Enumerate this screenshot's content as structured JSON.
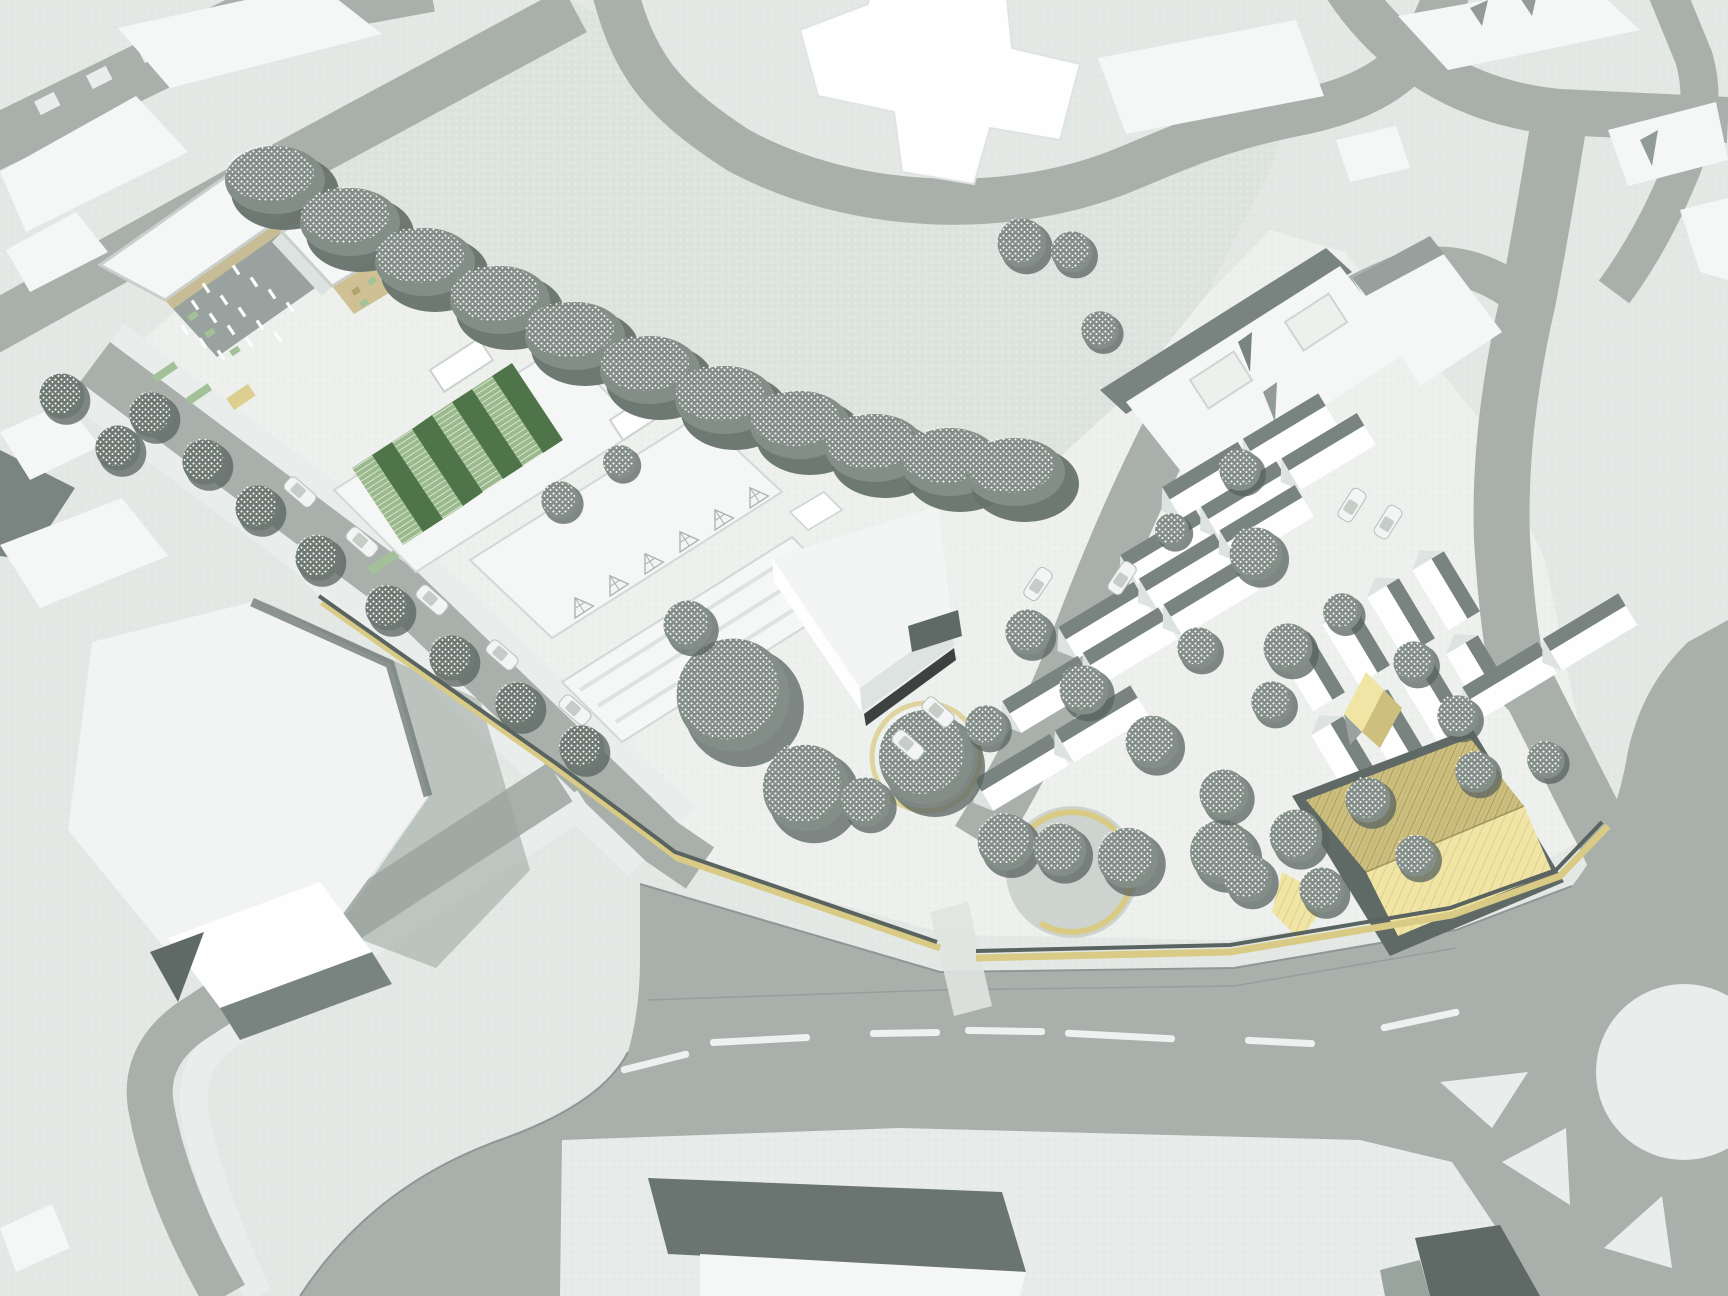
{
  "scene": {
    "title": "Urban masterplan aerial rendering",
    "description": "Bird's-eye axonometric architectural render of a mixed-use regeneration site: apartment blocks with timber and green facades, sheds with green sawtooth glazing, white office massing, rows of gabled terraced housing, a small timber pavilion and a large timber hall, a gold site boundary wall, a tree-lined avenue with parked cars, an open green field, and a main road with centre-line markings and a roundabout",
    "view": "aerial-axonometric",
    "labels": {
      "residential_west": "apartment blocks with timber and green facades",
      "greenhouse_sheds": "sheds with green sawtooth glazing",
      "office_slabs": "white office slabs",
      "office_box": "white office box with dark plinth",
      "terraced_housing": "gabled terraced housing rows",
      "courtyard_building": "L-shaped courtyard building",
      "timber_chapel": "small timber gabled pavilion",
      "timber_hall": "large timber gabled hall",
      "boundary_wall": "gold site boundary wall",
      "avenue": "tree-lined avenue with parked cars",
      "main_road": "main road with centre-line markings",
      "roundabout": "roundabout with traffic islands",
      "field": "open green space",
      "tree_line": "mature tree belt",
      "plaza": "circular plaza with seating wall"
    }
  },
  "colors": {
    "bg": "#e3e8e5",
    "field": "#dde3df",
    "site": "#edf0ed",
    "south": "#e7ebe9",
    "road": "#a9b0ac",
    "road_edge": "#8f9794",
    "white_roof": "#f4f7f5",
    "white_bright": "#fefefe",
    "facade_light": "#dde3e0",
    "facade_gray": "#99a29e",
    "facade_dark": "#79837f",
    "shadow_dark": "#5f6a67",
    "shadow_mid": "#9aa49f",
    "tan": "#cfc193",
    "tan_dark": "#b2a26e",
    "green_glass": "#9ab98c",
    "green_dark": "#50744a",
    "green_screen": "#a3c199",
    "timber_light": "#f0e5a4",
    "timber_mid": "#cdbf7e",
    "timber_dark": "#a2955c",
    "wall_gold": "#d9cb85",
    "wall_top": "#59635f",
    "tree": "#848e89",
    "tree_street": "#6e7973",
    "tree_shadow": "#58635f",
    "tree_line": "#67726c",
    "car": "#f2f5f3",
    "marking": "#eef1ef",
    "island": "#e9edeb",
    "black": "#1d2321"
  },
  "treeline": [
    [
      275,
      180
    ],
    [
      350,
      222
    ],
    [
      425,
      262
    ],
    [
      500,
      300
    ],
    [
      575,
      336
    ],
    [
      650,
      370
    ],
    [
      725,
      400
    ],
    [
      800,
      425
    ],
    [
      875,
      448
    ],
    [
      950,
      462
    ],
    [
      1015,
      472
    ]
  ],
  "trees": {
    "street": [
      [
        152,
        415
      ],
      [
        205,
        462
      ],
      [
        258,
        508
      ],
      [
        318,
        558
      ],
      [
        388,
        608
      ],
      [
        452,
        658
      ],
      [
        518,
        705
      ],
      [
        582,
        748
      ],
      [
        118,
        448
      ],
      [
        62,
        396
      ]
    ],
    "park": [
      [
        733,
        695,
        60
      ],
      [
        806,
        788,
        46
      ],
      [
        926,
        757,
        50
      ],
      [
        688,
        625,
        26
      ],
      [
        1006,
        842,
        30
      ],
      [
        1128,
        858,
        32
      ],
      [
        1222,
        852,
        34
      ],
      [
        866,
        802,
        26
      ],
      [
        1060,
        850,
        28
      ]
    ],
    "housing": [
      [
        1028,
        632,
        24
      ],
      [
        1084,
        690,
        26
      ],
      [
        1152,
        742,
        28
      ],
      [
        1224,
        794,
        26
      ],
      [
        1296,
        836,
        28
      ],
      [
        1368,
        800,
        24
      ],
      [
        1272,
        702,
        22
      ],
      [
        1198,
        648,
        22
      ],
      [
        1342,
        612,
        20
      ],
      [
        1414,
        662,
        22
      ],
      [
        1458,
        716,
        22
      ],
      [
        986,
        726,
        22
      ],
      [
        1248,
        878,
        26
      ],
      [
        1322,
        890,
        24
      ],
      [
        1416,
        856,
        22
      ],
      [
        1256,
        554,
        28
      ],
      [
        1288,
        648,
        26
      ],
      [
        1240,
        470,
        22
      ],
      [
        1022,
        243,
        26
      ],
      [
        1072,
        252,
        22
      ],
      [
        1100,
        330,
        20
      ],
      [
        1476,
        772,
        22
      ],
      [
        1546,
        760,
        20
      ],
      [
        560,
        500,
        20
      ],
      [
        620,
        462,
        18
      ],
      [
        1172,
        530,
        18
      ]
    ]
  },
  "cars": [
    [
      300,
      492,
      41
    ],
    [
      362,
      542,
      41
    ],
    [
      432,
      600,
      41
    ],
    [
      502,
      655,
      41
    ],
    [
      575,
      710,
      41
    ],
    [
      908,
      745,
      41
    ],
    [
      938,
      712,
      41
    ],
    [
      1038,
      584,
      -56
    ],
    [
      1122,
      578,
      -56
    ],
    [
      1352,
      505,
      -58
    ],
    [
      1388,
      522,
      -58
    ]
  ],
  "houses": {
    "rows": [
      {
        "x": 1170,
        "y": 500,
        "n": 2,
        "a": -31
      },
      {
        "x": 1128,
        "y": 568,
        "n": 3,
        "a": -31
      },
      {
        "x": 1066,
        "y": 640,
        "n": 3,
        "a": -31
      },
      {
        "x": 1010,
        "y": 714,
        "n": 3,
        "a": -31
      },
      {
        "x": 982,
        "y": 792,
        "n": 2,
        "a": -31
      },
      {
        "x": 1296,
        "y": 640,
        "n": 1,
        "a": 59,
        "l": 70
      },
      {
        "x": 1341,
        "y": 613,
        "n": 1,
        "a": 59,
        "l": 70
      },
      {
        "x": 1386,
        "y": 586,
        "n": 1,
        "a": 59,
        "l": 70
      },
      {
        "x": 1431,
        "y": 559,
        "n": 1,
        "a": 59,
        "l": 70
      },
      {
        "x": 1330,
        "y": 724,
        "n": 1,
        "a": 59,
        "l": 70
      },
      {
        "x": 1375,
        "y": 697,
        "n": 1,
        "a": 59,
        "l": 70
      },
      {
        "x": 1420,
        "y": 670,
        "n": 1,
        "a": 59,
        "l": 70
      },
      {
        "x": 1465,
        "y": 643,
        "n": 1,
        "a": 59,
        "l": 70
      },
      {
        "x": 1470,
        "y": 700,
        "n": 2,
        "a": -31
      }
    ],
    "len": 88,
    "bright_w": 22,
    "dark_w": 15,
    "spacing": 94
  },
  "slits": [
    [
      195,
      305
    ],
    [
      213,
      318
    ],
    [
      231,
      330
    ],
    [
      249,
      342
    ],
    [
      206,
      288
    ],
    [
      224,
      300
    ],
    [
      242,
      312
    ],
    [
      260,
      325
    ],
    [
      278,
      337
    ],
    [
      236,
      270
    ],
    [
      254,
      282
    ],
    [
      272,
      294
    ],
    [
      290,
      307
    ],
    [
      185,
      330
    ],
    [
      203,
      343
    ],
    [
      221,
      355
    ]
  ],
  "dashes": [
    [
      655,
      1062,
      70,
      -14
    ],
    [
      760,
      1040,
      100,
      -3
    ],
    [
      905,
      1033,
      70,
      -1
    ],
    [
      1005,
      1031,
      80,
      1
    ],
    [
      1120,
      1036,
      110,
      3
    ],
    [
      1280,
      1042,
      70,
      3
    ],
    [
      1420,
      1020,
      80,
      -12
    ]
  ],
  "ticks": [
    [
      1062,
      512
    ],
    [
      1052,
      546
    ],
    [
      1042,
      580
    ],
    [
      1033,
      614
    ],
    [
      1025,
      648
    ]
  ],
  "trusses": [
    [
      575,
      618
    ],
    [
      610,
      596
    ],
    [
      645,
      574
    ],
    [
      680,
      552
    ],
    [
      715,
      530
    ],
    [
      750,
      508
    ]
  ]
}
